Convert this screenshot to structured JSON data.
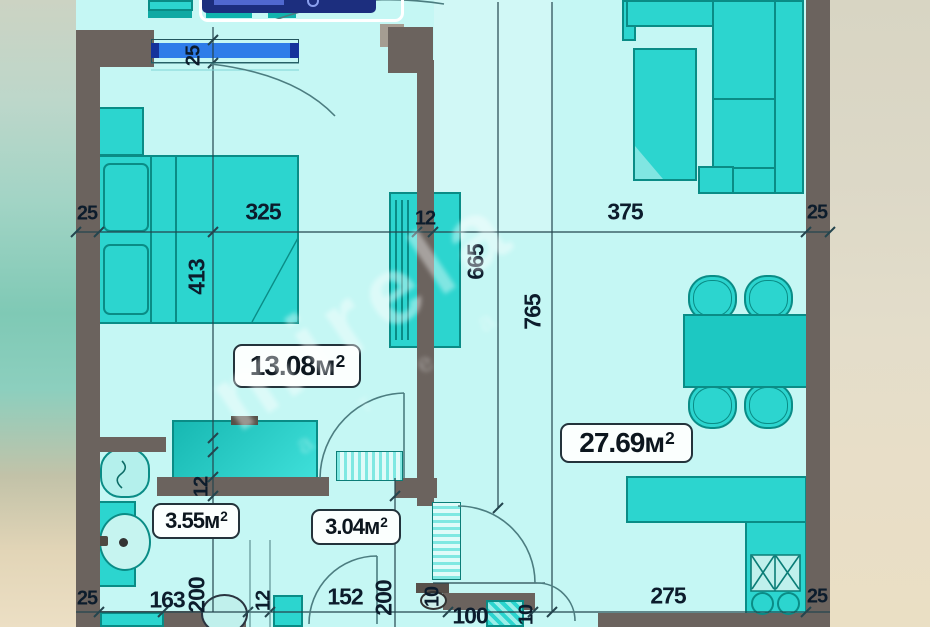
{
  "plan": {
    "watermark": {
      "primary": "mirela",
      "secondary": "а т е а"
    },
    "areas": [
      {
        "room": "bedroom",
        "value": "13.08м",
        "sup": "2"
      },
      {
        "room": "living",
        "value": "27.69м",
        "sup": "2"
      },
      {
        "room": "bathroom",
        "value": "3.55м",
        "sup": "2"
      },
      {
        "room": "hallway",
        "value": "3.04м",
        "sup": "2"
      }
    ],
    "dimensions": {
      "top": [
        "25",
        "325",
        "12",
        "375",
        "25"
      ],
      "left_vertical": [
        "25",
        "413",
        "12",
        "200"
      ],
      "middle_vertical": [
        "665",
        "765"
      ],
      "bottom": [
        "25",
        "163",
        "12",
        "152",
        "200",
        "10",
        "100",
        "10",
        "275",
        "25"
      ]
    },
    "colors": {
      "floor": "#c5f7f4",
      "wall": "#6b635e",
      "furniture": "#2cd5cf",
      "furniture_border": "#0a8c86",
      "window_blue": "#2e7ce9",
      "badge_navy": "#1c2e7e",
      "dimension_text": "#0c1c2c"
    }
  }
}
